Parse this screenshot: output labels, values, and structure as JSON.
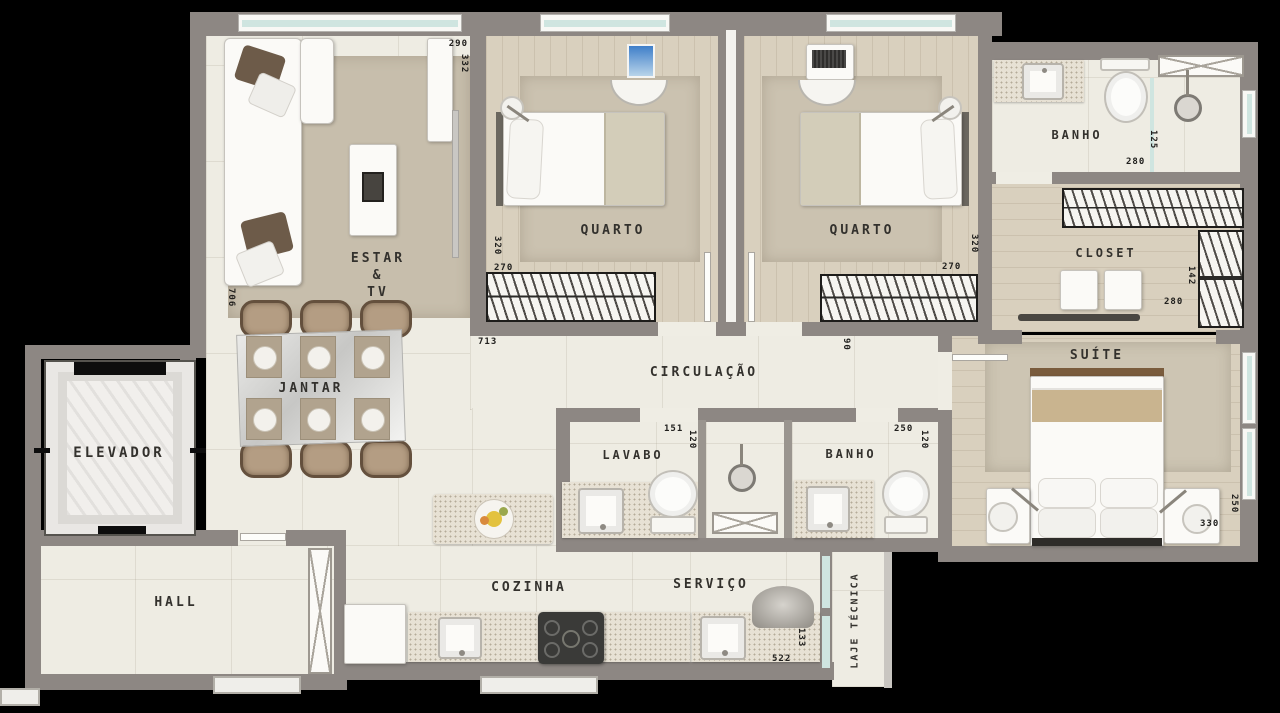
{
  "labels": {
    "estar1": "ESTAR",
    "estar2": "&",
    "estar3": "TV",
    "quarto1": "QUARTO",
    "quarto2": "QUARTO",
    "banho_suite": "BANHO",
    "closet": "CLOSET",
    "suite": "SUÍTE",
    "circulacao": "CIRCULAÇÃO",
    "jantar": "JANTAR",
    "elevador": "ELEVADOR",
    "hall": "HALL",
    "lavabo": "LAVABO",
    "banho_social": "BANHO",
    "cozinha": "COZINHA",
    "servico": "SERVIÇO",
    "laje": "LAJE TÉCNICA"
  },
  "dims": {
    "estar_w": "290",
    "estar_h": "332",
    "estar_side": "706",
    "sala_w": "713",
    "q1_h": "320",
    "q1_w": "270",
    "q2_h": "320",
    "q2_w": "270",
    "banho_suite_w": "280",
    "banho_suite_h": "125",
    "closet_w": "280",
    "closet_h": "142",
    "porta": "90",
    "lavabo_w": "151",
    "lavabo_h": "120",
    "banho_social_w": "250",
    "banho_social_h": "120",
    "suite_w": "330",
    "suite_h": "250",
    "servico_w": "522",
    "servico_h": "133"
  },
  "palette": {
    "background": "#000000",
    "wall": "#8d8783",
    "floor": "#eeece3",
    "wood": "#d9d0be",
    "rug": "#c7beac",
    "glass": "#cfe5e0",
    "text": "#33312d"
  }
}
